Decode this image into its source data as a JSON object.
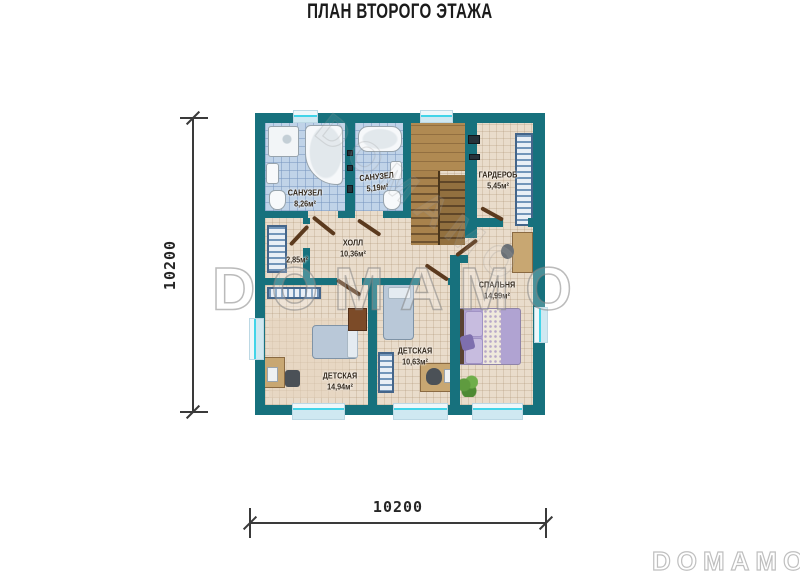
{
  "page": {
    "title": "ПЛАН ВТОРОГО ЭТАЖА"
  },
  "watermarks": {
    "center": "DOMAMO",
    "corner": "DOMAMO",
    "diagonal": "DOMAMO"
  },
  "dimension_labels": {
    "left": "10200",
    "bottom": "10200"
  },
  "rooms": [
    {
      "name": "САНУЗЕЛ",
      "area": "8,26м²"
    },
    {
      "name": "САНУЗЕЛ",
      "area": "5,19м²"
    },
    {
      "name": "ГАРДЕРОБ",
      "area": "5,45м²"
    },
    {
      "name": "ХОЛЛ",
      "area": "10,36м²"
    },
    {
      "name": "",
      "area": "2,85м²"
    },
    {
      "name": "СПАЛЬНЯ",
      "area": "14,99м²"
    },
    {
      "name": "ДЕТСКАЯ",
      "area": "14,94м²"
    },
    {
      "name": "ДЕТСКАЯ",
      "area": "10,63м²"
    }
  ],
  "colors": {
    "wall": "#17717d",
    "floor": "#e9dccb",
    "tile": "#c0d3e8",
    "wood": "#b08a52",
    "accent": "#41d4e8",
    "door": "#5b3a1e",
    "label": "#32271a"
  }
}
